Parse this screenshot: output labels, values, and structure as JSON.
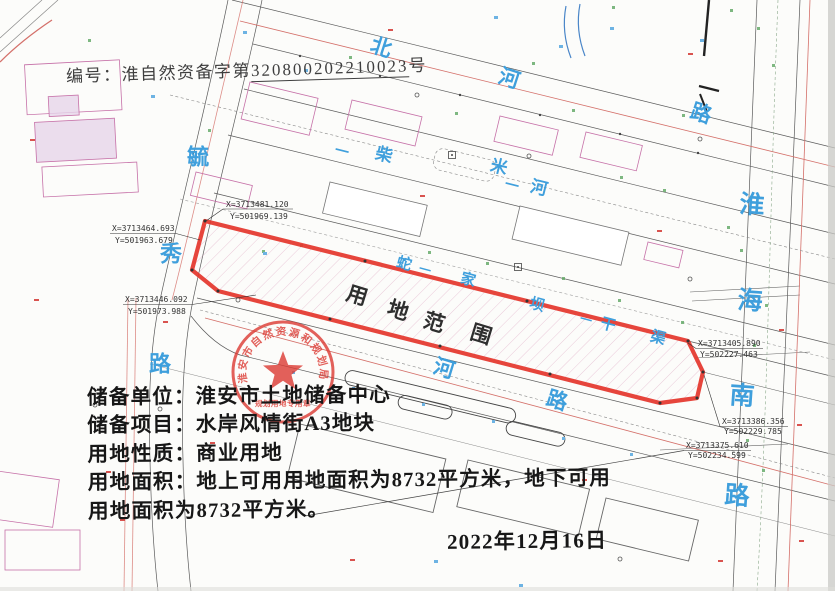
{
  "header": {
    "label": "编号：",
    "number_prefix": "淮自然资备字第",
    "number": "320800202210023",
    "number_suffix": "号"
  },
  "map": {
    "parcel_label_chars": [
      "用",
      "地",
      "范",
      "围"
    ],
    "roads": {
      "north": {
        "chars": [
          "北",
          "河",
          "路"
        ]
      },
      "river": {
        "chars": [
          "一",
          "柴",
          "米",
          "一",
          "河"
        ]
      },
      "west": {
        "chars": [
          "毓",
          "秀",
          "路"
        ]
      },
      "canal": {
        "chars": [
          "蛇",
          "一",
          "家",
          "坝",
          "一",
          "干",
          "渠"
        ]
      },
      "south": {
        "chars": [
          "河",
          "路"
        ]
      },
      "east": {
        "chars": [
          "淮",
          "海",
          "南",
          "路"
        ]
      }
    },
    "coords": [
      {
        "x": "X=3713481.120",
        "y": "Y=501969.139"
      },
      {
        "x": "X=3713464.693",
        "y": "Y=501963.679"
      },
      {
        "x": "X=3713446.092",
        "y": "Y=501973.988"
      },
      {
        "x": "X=3713405.890",
        "y": "Y=502227.463"
      },
      {
        "x": "X=3713386.356",
        "y": "Y=502229.785"
      },
      {
        "x": "X=3713375.610",
        "y": "Y=502234.599"
      }
    ]
  },
  "stamp": {
    "ring_text": "淮安市自然资源和规划局",
    "inner_text": "规划用地专用章"
  },
  "details": {
    "line1": "储备单位：淮安市土地储备中心",
    "line2": "储备项目：水岸风情街A3地块",
    "line3": "用地性质：商业用地",
    "line4": "用地面积：地上可用用地面积为8732平方米，地下可用",
    "line5": "用地面积为8732平方米。",
    "date": "2022年12月16日"
  },
  "colors": {
    "boundary_red": "#e5362c",
    "label_blue": "#3f9fdc",
    "stamp_red": "#dc3a33",
    "linework_gray": "#5a5a5a",
    "building_pink": "#c671a8"
  }
}
